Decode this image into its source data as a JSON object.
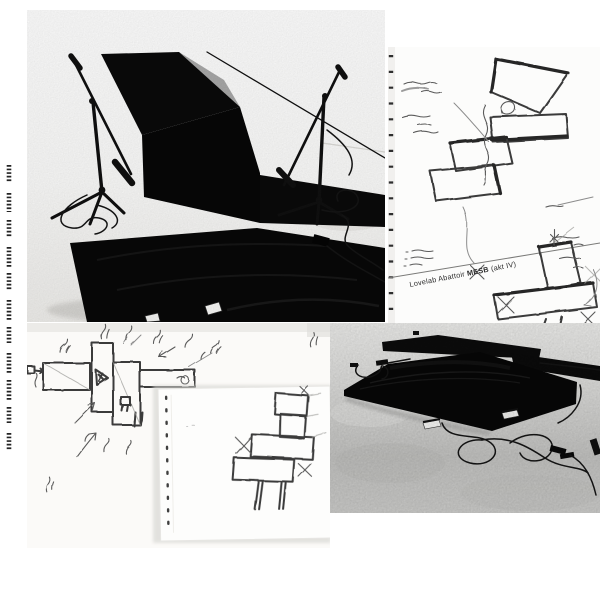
{
  "page": {
    "width": 600,
    "height": 600,
    "background": "#ffffff"
  },
  "caption": {
    "prefix": "Lovelab Abattoir ",
    "bold": "MESB",
    "suffix": " (akt IV)"
  },
  "colors": {
    "panel_black": "#0a0a0a",
    "pencil_dark": "#3a3a3a",
    "pencil_light": "#8c8c8c",
    "paper_white": "#fcfcfb",
    "concrete_light": "#ececea",
    "concrete_dark": "#c2c2c0",
    "caption_ink": "#2b2b2b"
  }
}
